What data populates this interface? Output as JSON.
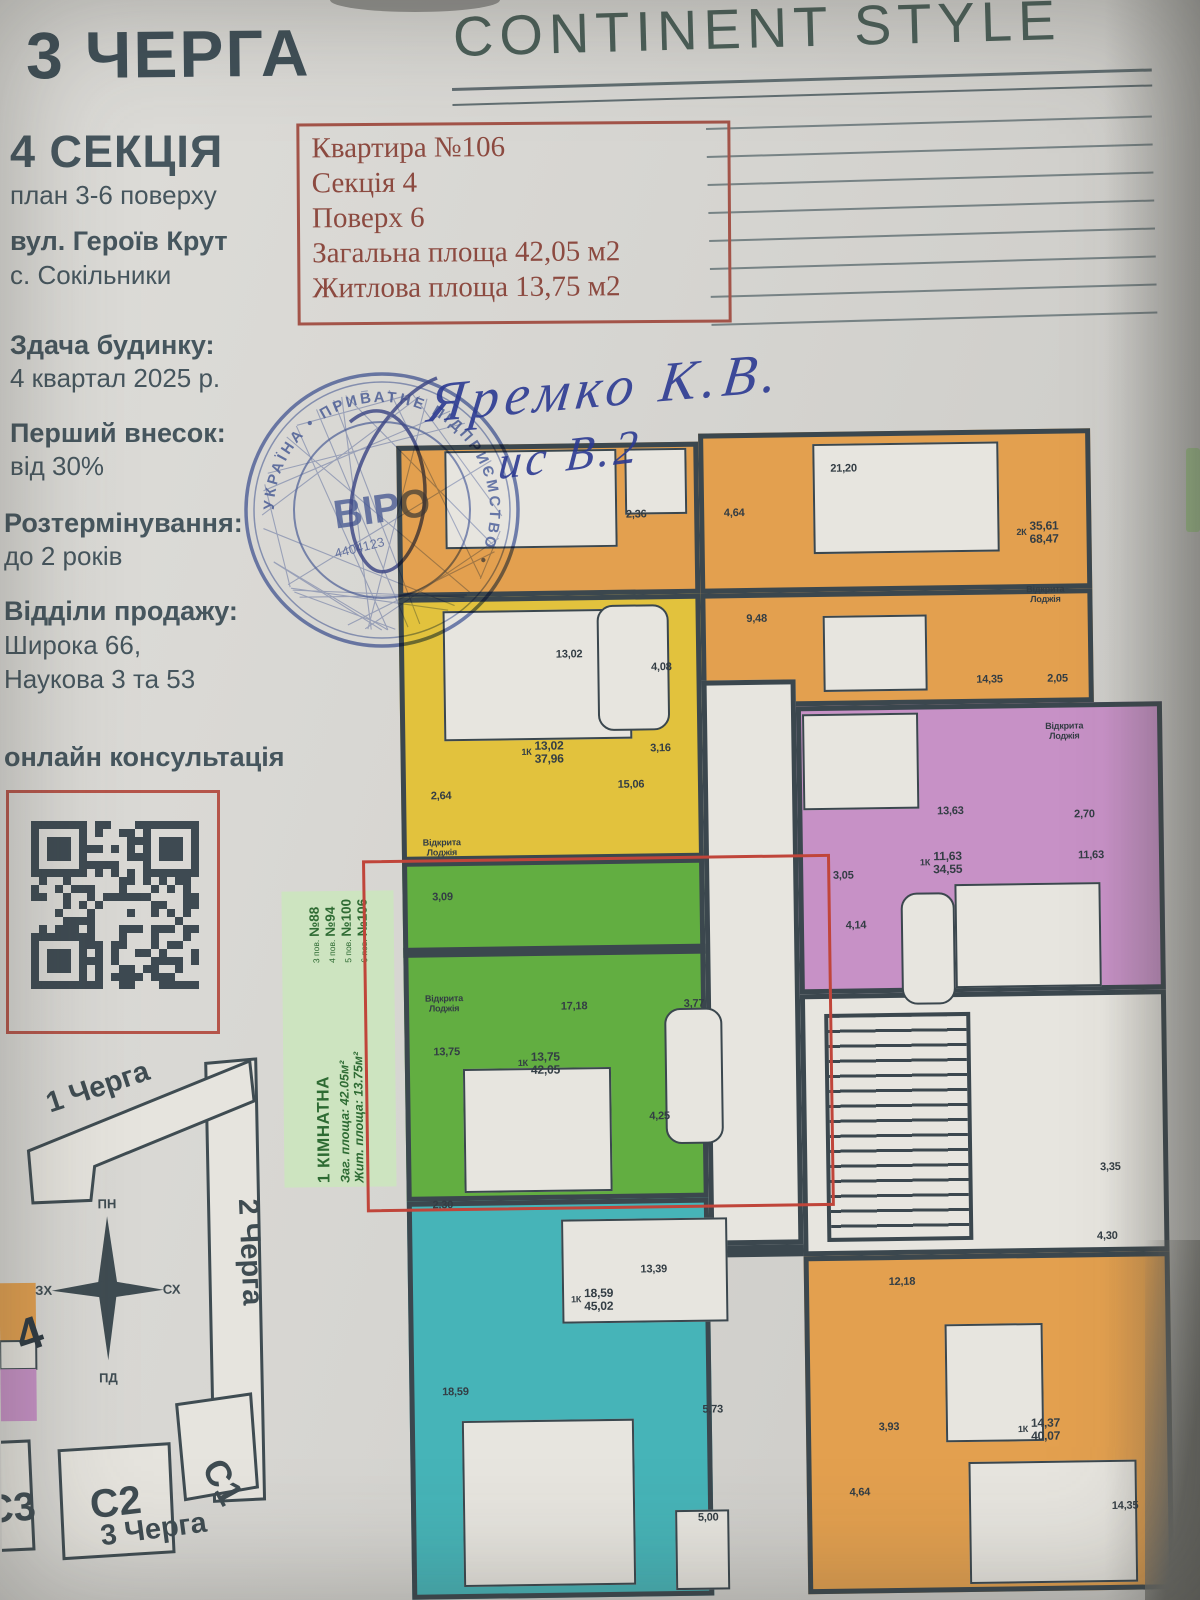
{
  "header": {
    "phase": "3 ЧЕРГА",
    "brand": "CONTINENT STYLE"
  },
  "info_box": {
    "lines": [
      "Квартира №106",
      "Секція 4",
      "Поверх 6",
      "Загальна площа 42,05 м2",
      "Житлова площа 13,75 м2"
    ]
  },
  "sidebar": {
    "section_title": "4 СЕКЦІЯ",
    "section_subtitle": "план 3-6 поверху",
    "address_line1": "вул. Героїв Крут",
    "address_line2": "с. Сокільники",
    "handover_title": "Здача будинку:",
    "handover_text": "4 квартал 2025 р.",
    "deposit_title": "Перший внесок:",
    "deposit_text": "від 30%",
    "installment_title": "Розтермінування:",
    "installment_text": "до 2 років",
    "sales_title": "Відділи продажу:",
    "sales_line1": "Широка 66,",
    "sales_line2": "Наукова 3 та 53",
    "qr_label": "онлайн консультація"
  },
  "handwriting": {
    "line1": "Яремко К.В.",
    "line2": "ис В.2"
  },
  "stamp": {
    "ring_text": "УКРАЇНА • ПРИВАТНЕ ПІДПРИЄМСТВО •",
    "center_text": "ВІРО",
    "number": "4404123"
  },
  "offer_label": {
    "title": "1 КІМНАТНА",
    "area_total": "Заг. площа: 42.05м²",
    "area_living": "Жит. площа: 13.75м²",
    "floors": [
      {
        "floor": "3 пов.",
        "num": "№88"
      },
      {
        "floor": "4 пов.",
        "num": "№94"
      },
      {
        "floor": "5 пов.",
        "num": "№100"
      },
      {
        "floor": "6 пов.",
        "num": "№106"
      }
    ]
  },
  "site_map": {
    "phase1": "1 Черга",
    "phase2": "2 Черга",
    "phase3": "3 Черга",
    "compass": {
      "n": "ПН",
      "s": "ПД",
      "w": "ЗХ",
      "e": "СХ"
    },
    "building1": "С1",
    "building2": "С2",
    "building3": "С3",
    "section_marker": "4"
  },
  "colors": {
    "paper": "#d6d5d1",
    "ink": "#46565e",
    "red_text": "#8c4a40",
    "wall": "#3b474e",
    "orange": "#e3a04f",
    "yellow": "#e2c23d",
    "green": "#62ae41",
    "cyan": "#46b4b8",
    "purple": "#c791c6",
    "white_room": "#e7e5df",
    "label_green_bg": "#cde4c0",
    "label_green_ink": "#2e6b33",
    "highlight": "#c0453a",
    "stamp_blue": "#3a53a5",
    "qr_dark": "#3e4a52"
  },
  "plan": {
    "blocks": [
      {
        "n": "apt-2k-top-left",
        "c": "orange",
        "x": 8,
        "y": 16,
        "w": 302,
        "h": 152
      },
      {
        "n": "apt-2k-top-right",
        "c": "orange",
        "x": 310,
        "y": 8,
        "w": 392,
        "h": 160
      },
      {
        "n": "apt-2k-dining",
        "c": "orange",
        "x": 310,
        "y": 168,
        "w": 392,
        "h": 114
      },
      {
        "n": "apt-1k-yellow",
        "c": "yellow",
        "x": 8,
        "y": 168,
        "w": 302,
        "h": 264
      },
      {
        "n": "apt-1k-green",
        "c": "green",
        "x": 8,
        "y": 432,
        "w": 302,
        "h": 340
      },
      {
        "n": "apt-1k-cyan",
        "c": "cyan",
        "x": 8,
        "y": 772,
        "w": 302,
        "h": 398
      },
      {
        "n": "corridor-center",
        "c": "white_room",
        "x": 310,
        "y": 255,
        "w": 94,
        "h": 565
      },
      {
        "n": "apt-1k-purple",
        "c": "purple",
        "x": 404,
        "y": 282,
        "w": 366,
        "h": 288
      },
      {
        "n": "stair-hall",
        "c": "white_room",
        "x": 404,
        "y": 570,
        "w": 366,
        "h": 262
      },
      {
        "n": "apt-1k-bottom-right",
        "c": "orange",
        "x": 404,
        "y": 832,
        "w": 366,
        "h": 338
      }
    ],
    "furniture": [
      {
        "x": 56,
        "y": 22,
        "w": 172,
        "h": 98
      },
      {
        "x": 236,
        "y": 22,
        "w": 62,
        "h": 66
      },
      {
        "x": 424,
        "y": 20,
        "w": 186,
        "h": 110
      },
      {
        "x": 432,
        "y": 192,
        "w": 104,
        "h": 76
      },
      {
        "x": 52,
        "y": 182,
        "w": 188,
        "h": 130
      },
      {
        "x": 206,
        "y": 178,
        "w": 72,
        "h": 126,
        "shape": "tub"
      },
      {
        "x": 66,
        "y": 640,
        "w": 148,
        "h": 124
      },
      {
        "x": 268,
        "y": 582,
        "w": 58,
        "h": 136,
        "shape": "tub"
      },
      {
        "x": 162,
        "y": 792,
        "w": 166,
        "h": 104
      },
      {
        "x": 60,
        "y": 992,
        "w": 172,
        "h": 166
      },
      {
        "x": 272,
        "y": 1084,
        "w": 54,
        "h": 80
      },
      {
        "x": 410,
        "y": 290,
        "w": 116,
        "h": 96
      },
      {
        "x": 506,
        "y": 470,
        "w": 54,
        "h": 112,
        "shape": "tub"
      },
      {
        "x": 560,
        "y": 462,
        "w": 146,
        "h": 104
      },
      {
        "x": 544,
        "y": 902,
        "w": 98,
        "h": 118
      },
      {
        "x": 566,
        "y": 1040,
        "w": 168,
        "h": 122
      }
    ],
    "stairs": {
      "x": 428,
      "y": 590,
      "w": 146,
      "h": 228
    },
    "walls": [
      {
        "x": 8,
        "y": 518,
        "w": 302,
        "h": 10
      },
      {
        "x": 310,
        "y": 820,
        "w": 94,
        "h": 12
      }
    ],
    "highlight": {
      "x": -32,
      "y": 430,
      "w": 462,
      "h": 346
    },
    "labels": [
      {
        "x": 247,
        "y": 88,
        "t": "2,36"
      },
      {
        "x": 345,
        "y": 88,
        "t": "4,64"
      },
      {
        "x": 455,
        "y": 45,
        "t": "21,20"
      },
      {
        "x": 648,
        "y": 112,
        "pre": "2К",
        "t": "35,61",
        "t2": "68,47",
        "s": 12
      },
      {
        "x": 655,
        "y": 174,
        "t": "Відкрита",
        "t2": "Лоджія",
        "s": 9
      },
      {
        "x": 366,
        "y": 194,
        "t": "9,48"
      },
      {
        "x": 598,
        "y": 258,
        "t": "14,35"
      },
      {
        "x": 666,
        "y": 258,
        "t": "2,05"
      },
      {
        "x": 178,
        "y": 227,
        "t": "13,02"
      },
      {
        "x": 270,
        "y": 241,
        "t": "4,08"
      },
      {
        "x": 150,
        "y": 325,
        "pre": "1К",
        "t": "13,02",
        "t2": "37,96",
        "s": 12
      },
      {
        "x": 268,
        "y": 322,
        "t": "3,16"
      },
      {
        "x": 238,
        "y": 358,
        "t": "15,06"
      },
      {
        "x": 48,
        "y": 367,
        "t": "2,64"
      },
      {
        "x": 48,
        "y": 419,
        "t": "Відкрита",
        "t2": "Лоджія",
        "s": 9
      },
      {
        "x": 48,
        "y": 468,
        "t": "3,09"
      },
      {
        "x": 48,
        "y": 575,
        "t": "Відкрита",
        "t2": "Лоджія",
        "s": 9
      },
      {
        "x": 178,
        "y": 579,
        "t": "17,18"
      },
      {
        "x": 298,
        "y": 578,
        "t": "3,77"
      },
      {
        "x": 50,
        "y": 623,
        "t": "13,75"
      },
      {
        "x": 142,
        "y": 636,
        "pre": "1К",
        "t": "13,75",
        "t2": "42,05",
        "s": 12
      },
      {
        "x": 262,
        "y": 690,
        "t": "4,25"
      },
      {
        "x": 44,
        "y": 776,
        "t": "2,30"
      },
      {
        "x": 254,
        "y": 843,
        "t": "13,39"
      },
      {
        "x": 192,
        "y": 873,
        "pre": "1К",
        "t": "18,59",
        "t2": "45,02",
        "s": 12
      },
      {
        "x": 54,
        "y": 963,
        "t": "18,59"
      },
      {
        "x": 311,
        "y": 984,
        "t": "5,73"
      },
      {
        "x": 305,
        "y": 1092,
        "t": "5,00"
      },
      {
        "x": 672,
        "y": 311,
        "t": "Відкрита",
        "t2": "Лоджія",
        "s": 9
      },
      {
        "x": 557,
        "y": 389,
        "t": "13,63"
      },
      {
        "x": 691,
        "y": 394,
        "t": "2,70"
      },
      {
        "x": 547,
        "y": 441,
        "pre": "1К",
        "t": "11,63",
        "t2": "34,55",
        "s": 12
      },
      {
        "x": 697,
        "y": 435,
        "t": "11,63"
      },
      {
        "x": 449,
        "y": 452,
        "t": "3,05"
      },
      {
        "x": 461,
        "y": 502,
        "t": "4,14"
      },
      {
        "x": 712,
        "y": 747,
        "t": "3,35"
      },
      {
        "x": 708,
        "y": 816,
        "t": "4,30"
      },
      {
        "x": 502,
        "y": 859,
        "t": "12,18"
      },
      {
        "x": 487,
        "y": 1004,
        "t": "3,93"
      },
      {
        "x": 637,
        "y": 1009,
        "pre": "1К",
        "t": "14,37",
        "t2": "40,07",
        "s": 12
      },
      {
        "x": 457,
        "y": 1069,
        "t": "4,64"
      },
      {
        "x": 722,
        "y": 1086,
        "t": "14,35"
      }
    ]
  }
}
